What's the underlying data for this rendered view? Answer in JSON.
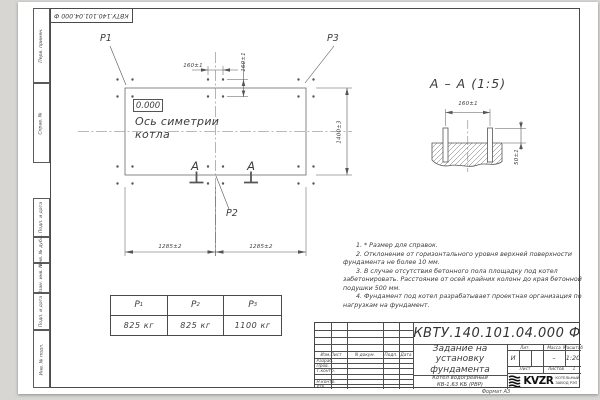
{
  "sheet": {
    "side_strip": [
      "Перв. примен.",
      "Справ. №",
      "Подп. и дата",
      "Инв. № дубл.",
      "Взам. инв. №",
      "Подп. и дата",
      "Инв. № подл."
    ],
    "format_note": "Формат А3"
  },
  "plan": {
    "point_labels": {
      "p1": "P1",
      "p2": "P2",
      "p3": "P3"
    },
    "elevation_mark": "0.000",
    "symmetry_axis_label": "Ось симетрии котла",
    "section_letter_left": "А",
    "section_letter_right": "А",
    "dims": {
      "bolt_spacing_h": "160±1",
      "bolt_spacing_v": "160±1",
      "width_left": "1285±2",
      "width_right": "1285±2",
      "depth": "1400±3"
    }
  },
  "section_view": {
    "title": "А – А (1:5)",
    "dims": {
      "bolt_spacing": "160±1",
      "protrusion": "50±1"
    }
  },
  "loads_table": {
    "headers": [
      {
        "base": "Р",
        "sub": "1"
      },
      {
        "base": "Р",
        "sub": "2"
      },
      {
        "base": "Р",
        "sub": "3"
      }
    ],
    "values": [
      "825 кг",
      "825 кг",
      "1100 кг"
    ]
  },
  "notes": [
    "1. * Размер для справок.",
    "2. Отклонение от горизонтального уровня верхней поверхности фундамента не более 10 мм.",
    "3. В случае отсутствия бетонного пола площадку под котел забетонировать. Расстояние от осей крайних колонн до края бетонной подушки 500 мм.",
    "4. Фундамент под котел разрабатывает проектная организация по нагрузкам на фундамент."
  ],
  "title_block": {
    "doc_number": "КВТУ.140.101.04.000  Ф",
    "document_title": "Задание на установку фундамента",
    "product_line1": "Котел водогрейный",
    "product_line2": "КВ-1,63 КБ (РВР)",
    "col_headers": {
      "lit": "Лит.",
      "mass": "Масса",
      "scale": "Масштаб"
    },
    "values": {
      "lit": "И",
      "mass": "–",
      "scale": "1:20"
    },
    "sheet_row": {
      "sheet": "Лист",
      "sheets": "Листов",
      "sheets_value": "1"
    },
    "rev_headers": {
      "izm": "Изм.Лист",
      "doc": "N докум.",
      "sign": "Подп.",
      "date": "Дата"
    },
    "sig_rows": [
      "Разраб.",
      "Пров.",
      "Т.контр.",
      "",
      "Н.контр.",
      "Утв."
    ],
    "logo": {
      "text": "KVZR",
      "line1": "КОТЕЛЬНЫЙ",
      "line2": "ЗАВОД РЭП"
    }
  },
  "colors": {
    "line": "#4a4a4a",
    "text": "#3c3c3c",
    "sheet": "#ffffff",
    "background": "#d7d6d3"
  }
}
